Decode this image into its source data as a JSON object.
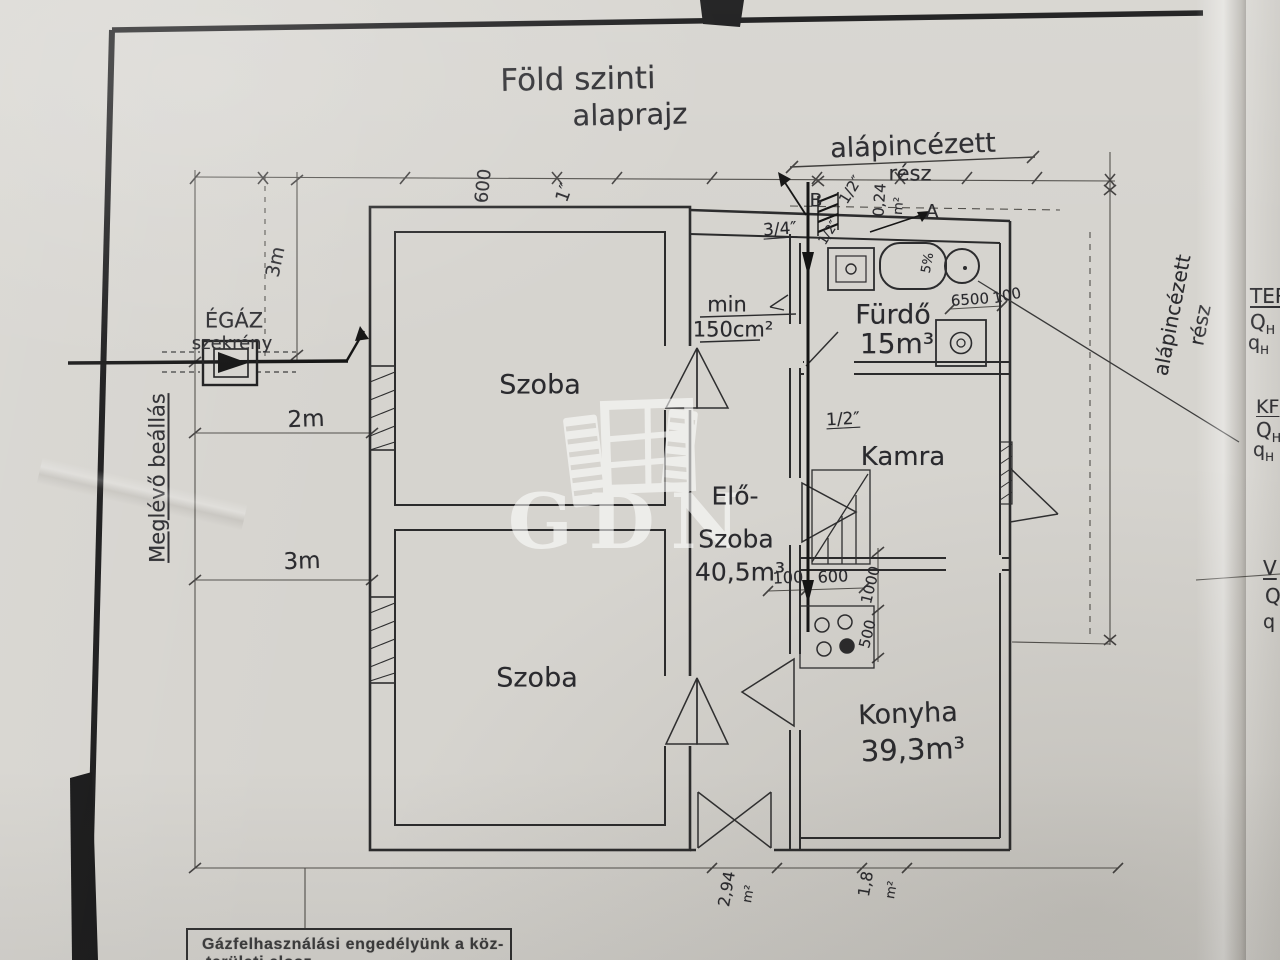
{
  "title": {
    "line1": "Föld szinti",
    "line2": "alaprajz"
  },
  "watermark": "GDN",
  "rooms": {
    "szoba_upper": "Szoba",
    "szoba_lower": "Szoba",
    "eloszoba_line1": "Elő-",
    "eloszoba_line2": "Szoba",
    "eloszoba_area": "40,5m³",
    "furdo": "Fürdő",
    "furdo_area": "15m³",
    "kamra": "Kamra",
    "konyha": "Konyha",
    "konyha_area": "39,3m³"
  },
  "annotations": {
    "basement_top_line1": "alápincézett",
    "basement_top_line2": "rész",
    "basement_right_line1": "alápincézett",
    "basement_right_line2": "rész",
    "gas_line1": "ÉGÁZ",
    "gas_line2": "szekrény",
    "existing_stand": "Meglévő beállás",
    "min_label": "min",
    "min_value": "150cm²",
    "marker_a": "A",
    "marker_b": "B",
    "pipe_three_quarter": "3/4″",
    "pipe_half_top": "1/2″",
    "pipe_half_mid": "1/2″",
    "pipe_half_kamra": "1/2″",
    "vent_area": "0,24",
    "vent_area_unit": "m²",
    "slope": "5%"
  },
  "dimensions": {
    "d600_top": "600",
    "d1_inch": "1″",
    "d3m_vert": "3m",
    "d2m": "2m",
    "d3m": "3m",
    "d6500": "6500",
    "d100_bath": "100",
    "d100_hall": "100",
    "d600_hall": "600",
    "d1000": "1000",
    "d500": "500",
    "d294": "2,94",
    "d294_unit": "m²",
    "d18": "1,8",
    "d18_unit": "m²"
  },
  "side_notes": {
    "ter": "TER",
    "qh1_main": "Q",
    "qh1_sub": "H",
    "qh1_eq": "=",
    "qh2_main": "q",
    "qh2_sub": "H",
    "kf": "KF",
    "qh3_main": "Q",
    "qh3_sub": "H",
    "qh4_main": "q",
    "qh4_sub": "H",
    "v": "V",
    "q5": "Q",
    "q6": "q"
  },
  "stamp": {
    "line1": "Gázfelhasználási engedélyünk a köz-",
    "line2": "területi elosz"
  }
}
